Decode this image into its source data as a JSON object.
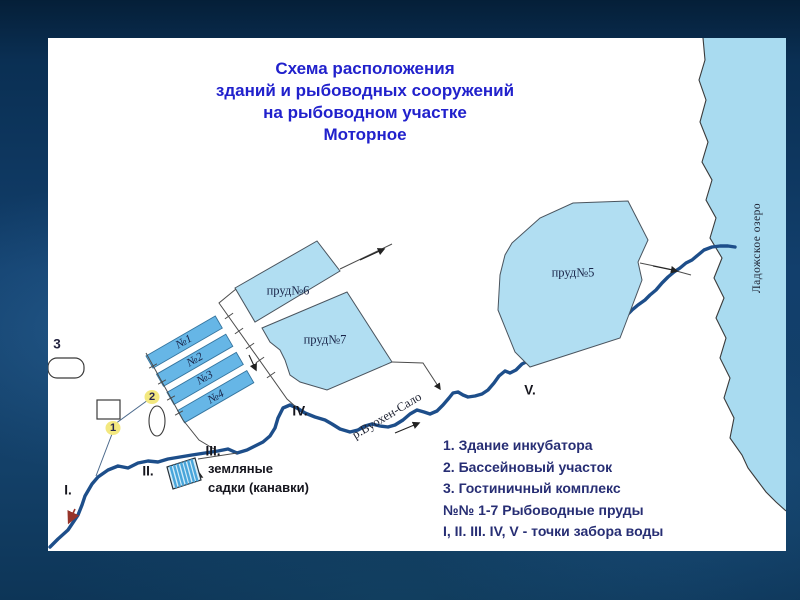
{
  "slide": {
    "title_lines": [
      "Схема расположения",
      "зданий и рыбоводных сооружений",
      "на рыбоводном участке",
      "Моторное"
    ]
  },
  "legend": {
    "items": [
      "1. Здание инкубатора",
      "2. Бассейновый участок",
      "3. Гостиничный комплекс",
      "№№ 1-7 Рыбоводные пруды",
      "I, II. III. IV, V - точки забора воды"
    ]
  },
  "map": {
    "lake_label": "Ладожское озеро",
    "river_label": "р.Вуохен-Сало",
    "pond_labels": {
      "p5": "пруд№5",
      "p6": "пруд№6",
      "p7": "пруд№7"
    },
    "basin_labels": [
      "№1",
      "№2",
      "№3",
      "№4"
    ],
    "intake_points": [
      "I.",
      "II.",
      "III.",
      "IV.",
      "V."
    ],
    "markers": {
      "incubator": "1",
      "basin_site": "2",
      "hotel": "3"
    },
    "hatch_label_lines": [
      "земляные",
      "садки (канавки)"
    ]
  },
  "colors": {
    "title_text": "#2121cc",
    "legend_text": "#272e74",
    "pond_fill": "#b1def2",
    "basin_fill": "#66b6e6",
    "lake_fill": "#a9dbf0",
    "river_stroke": "#1d4e8a",
    "marker_highlight": "#f3e87f"
  }
}
